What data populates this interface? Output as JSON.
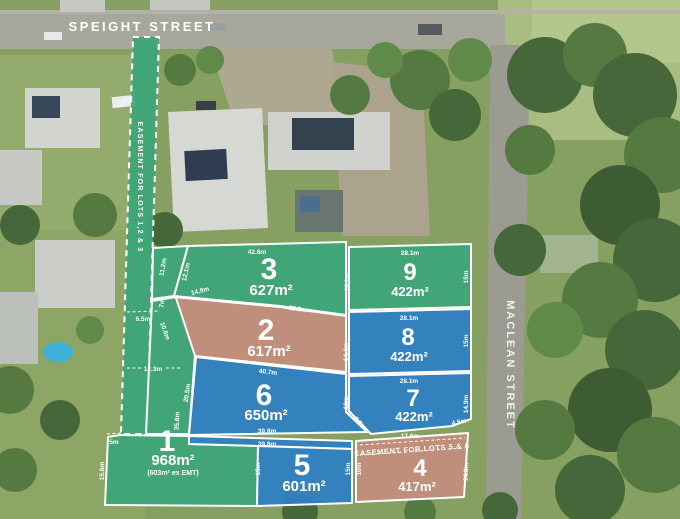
{
  "streets": {
    "top": "SPEIGHT STREET",
    "right": "MACLEAN STREET"
  },
  "easements": {
    "lots123": "EASEMENT FOR LOTS 1,2 & 3",
    "lots56": "EASEMENT FOR LOTS 5 & 6"
  },
  "lots": {
    "lot1": {
      "number": "1",
      "area": "968m²",
      "note": "(603m² ex EMT)"
    },
    "lot2": {
      "number": "2",
      "area": "617m²"
    },
    "lot3": {
      "number": "3",
      "area": "627m²"
    },
    "lot4": {
      "number": "4",
      "area": "417m²"
    },
    "lot5": {
      "number": "5",
      "area": "601m²"
    },
    "lot6": {
      "number": "6",
      "area": "650m²"
    },
    "lot7": {
      "number": "7",
      "area": "422m²"
    },
    "lot8": {
      "number": "8",
      "area": "422m²"
    },
    "lot9": {
      "number": "9",
      "area": "422m²"
    }
  },
  "colors": {
    "green": "#3da578",
    "blue": "#2e80c2",
    "salmon": "#c28e7d"
  },
  "dimensions": {
    "strip_width": "6.5m",
    "strip_seg7": "7m",
    "wedge_left": "11.2m",
    "wedge_right": "12.1m",
    "wedge_bottom": "14.9m",
    "corridor_width": "12.3m",
    "lot2_left_diag": "10.6m",
    "lot1_top_notch": "5m",
    "lot1_left": "15.6m",
    "lot3_top": "42.6m",
    "lot3_right": "18.1m",
    "lot3_bottom": "28.5m",
    "lot9_top": "28.1m",
    "lot9_right": "15m",
    "lot8_top": "28.1m",
    "lot8_right": "15m",
    "lot2_right": "14.4m",
    "lot2_bottom": "40.7m",
    "lot7_top": "28.1m",
    "lot7_right": "14.9m",
    "lot7_left": "12m",
    "lot7_corner": "4.5m",
    "lot7_bottom": "17.6m",
    "lot6_diag": "6.7m",
    "lot6_left_upper": "20.5m",
    "lot6_left_lower": "35.6m",
    "lot6_bottom": "39.8m",
    "lot5_top": "39.8m",
    "lot5_left": "15m",
    "lot5_right": "15m",
    "lot4_left": "10m",
    "lot4_right": "14.6m"
  }
}
